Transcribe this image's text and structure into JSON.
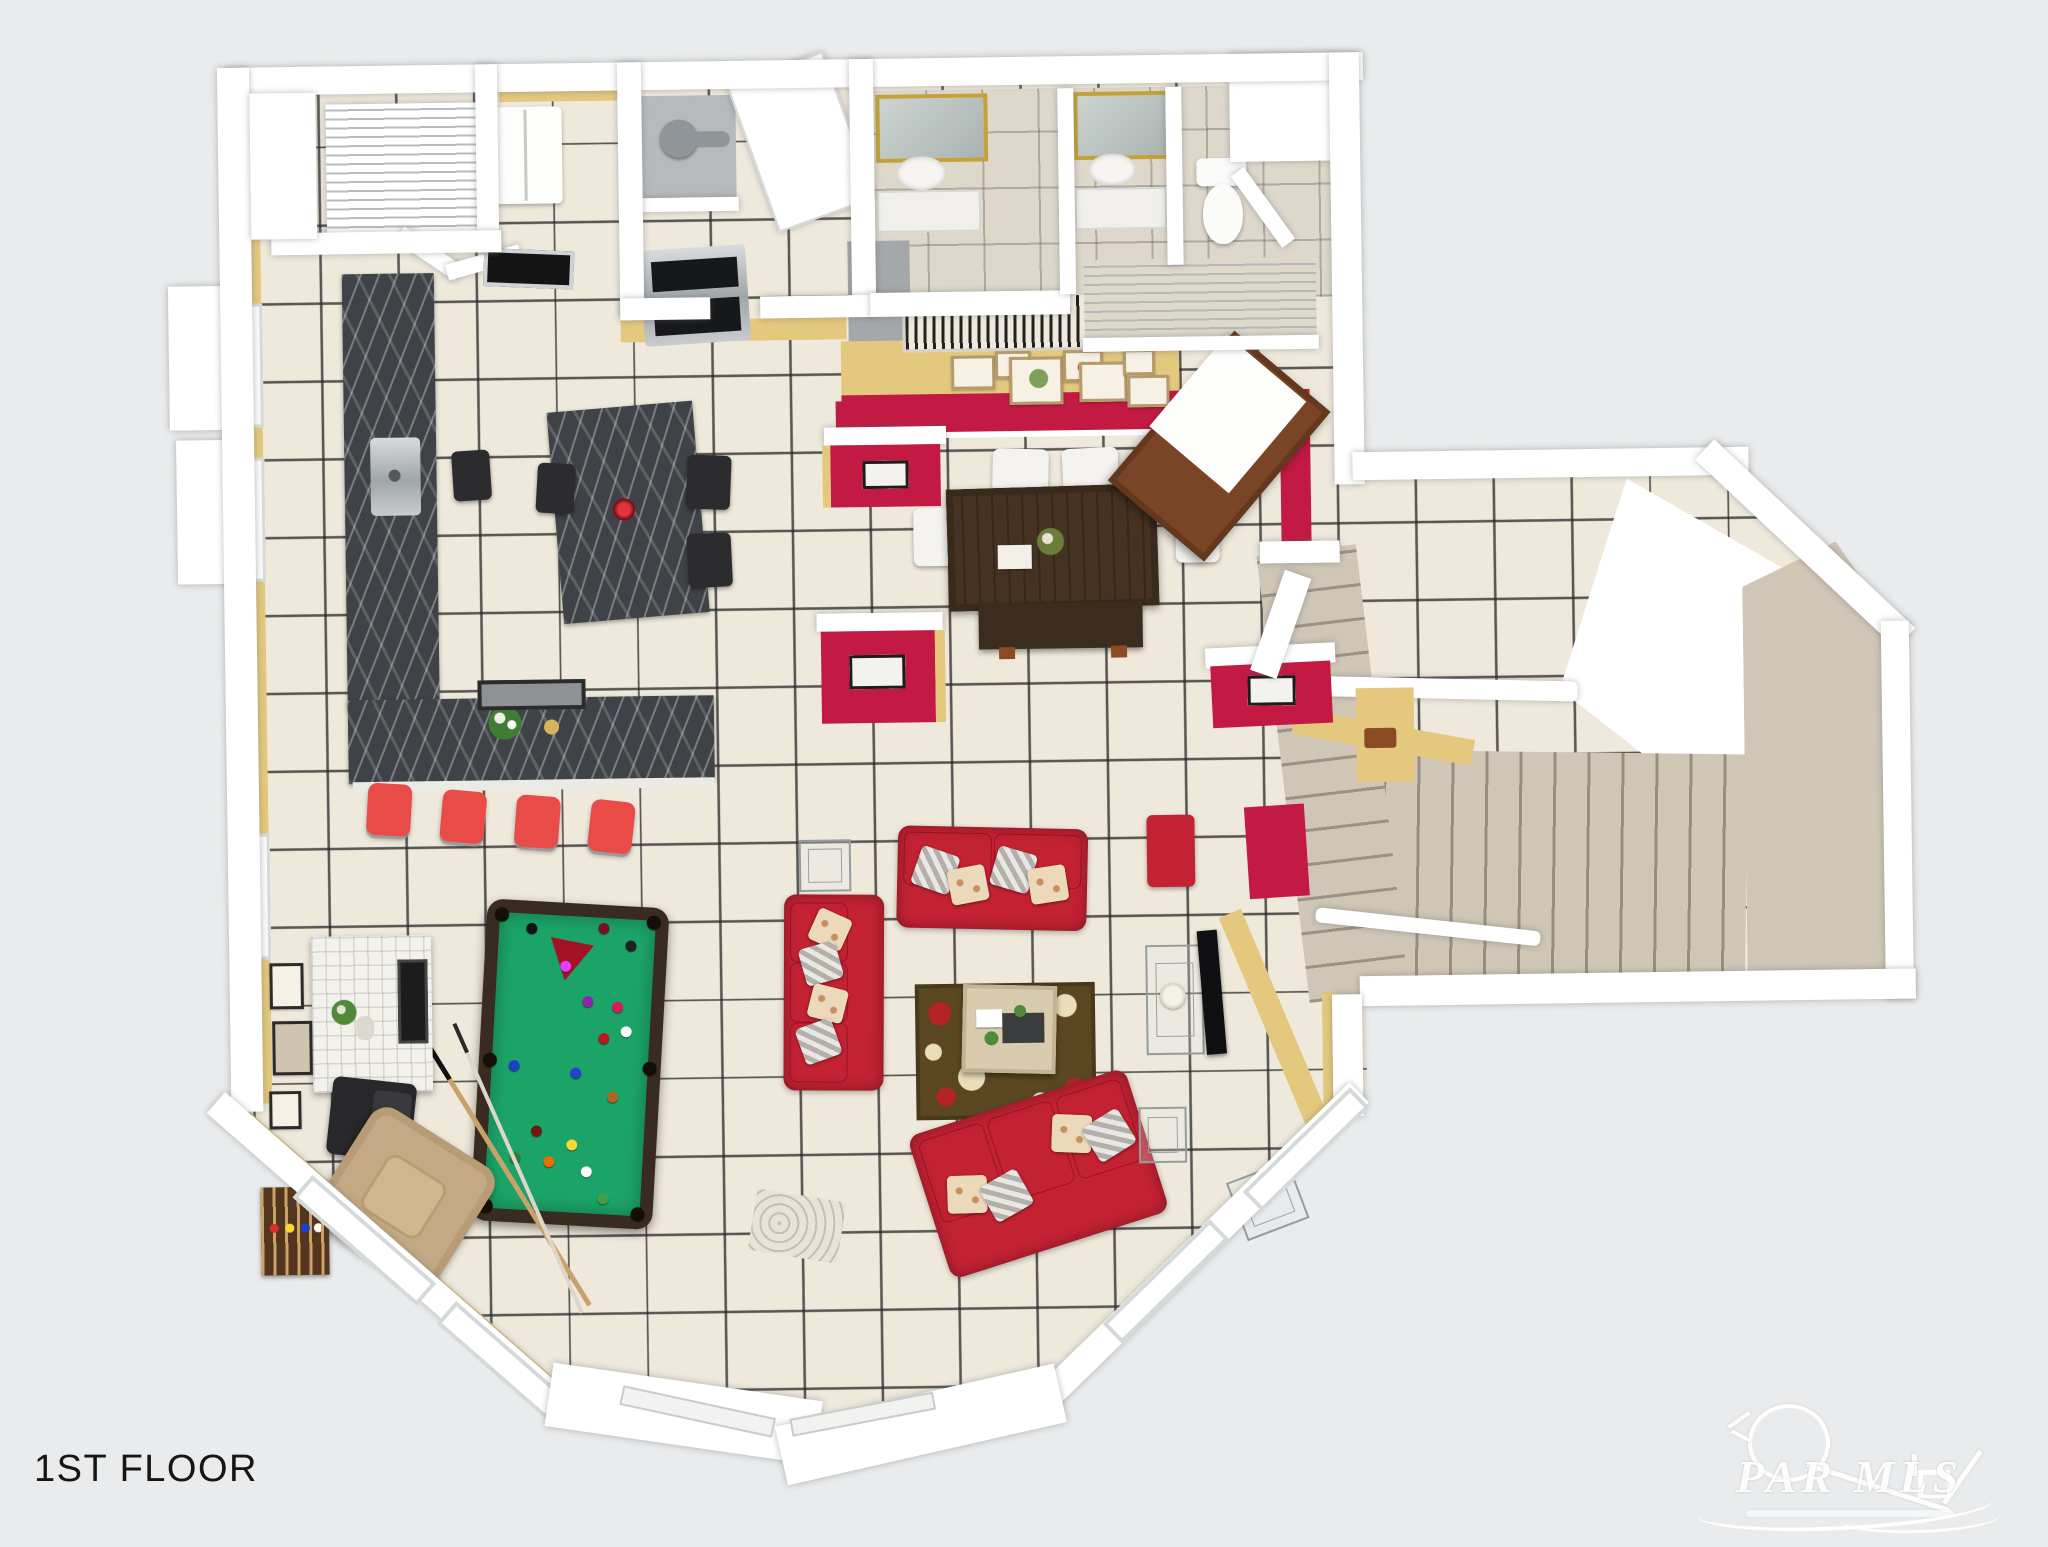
{
  "title": "1ST FLOOR",
  "watermark": {
    "text": "PAR MLS"
  },
  "palette": {
    "background": "#e9ebec",
    "wall": "#ffffff",
    "wall_yellow": "#e3c87e",
    "tile_floor": "#efe9dc",
    "bath_floor": "#ded8cb",
    "carpet": "#cfc6b6",
    "accent_red_wall": "#c21a42",
    "sofa_red": "#c32233",
    "stool_red": "#e94b47",
    "pool_felt_green": "#1ca468",
    "pool_rail_brown": "#3a2b20",
    "counter_marble": "#3f4347",
    "dining_wood": "#463222",
    "buffet_wood": "#7a4526",
    "recliner_tan": "#c4aa84",
    "rug_olive": "#5a4722"
  }
}
